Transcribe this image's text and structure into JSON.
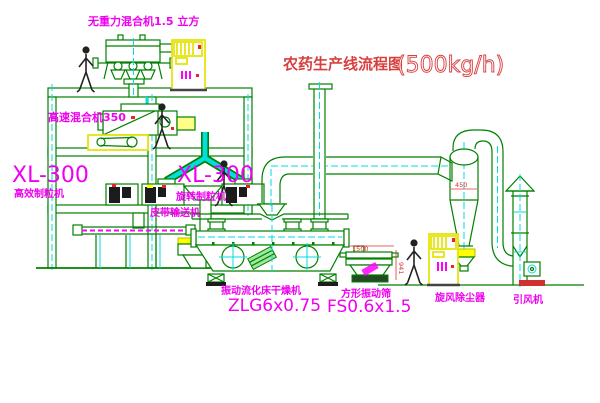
{
  "title": {
    "text": "农药生产线流程图",
    "capacity": "(500kg/h)"
  },
  "labels": {
    "gravity_mixer": "无重力混合机1.5 立方",
    "high_speed_mixer": "高速混合机350",
    "granulator_left_model": "XL-300",
    "granulator_left_name": "高效制粒机",
    "granulator_right_model": "XL-300",
    "granulator_right_name": "旋转制粒机",
    "belt_conveyor": "皮带输送机",
    "dryer_name": "振动流化床干燥机",
    "dryer_model": "ZLG6x0.75",
    "sieve_name": "方形振动筛",
    "sieve_model": "FS0.6x1.5",
    "cyclone_name": "旋风除尘器",
    "fan_name": "引风机"
  },
  "dimensions": {
    "cyclone_dia": "450",
    "sieve_width": "1500",
    "sieve_height": "941"
  },
  "colors": {
    "line_green": "#008000",
    "centerline_cyan": "#00dede",
    "label_magenta": "#f000f0",
    "title_red": "#d84040",
    "highlight_yellow": "#ffff00",
    "accent_red": "#ee2222"
  }
}
